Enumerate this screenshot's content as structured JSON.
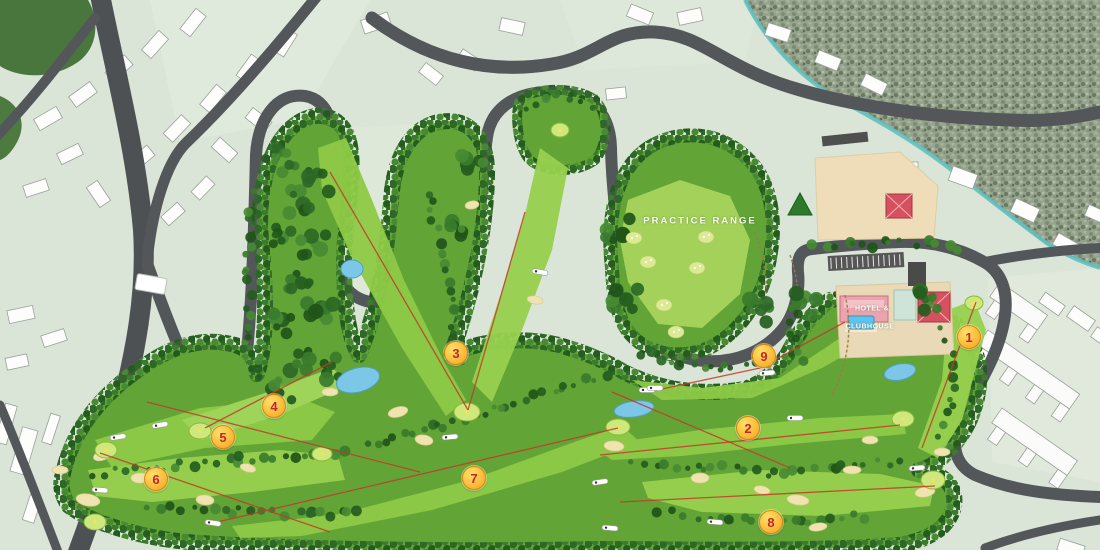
{
  "map": {
    "labels": {
      "practice_range": "PRACTICE RANGE",
      "hotel_clubhouse_line1": "HOTEL &",
      "hotel_clubhouse_line2": "CLUBHOUSE"
    },
    "holes": [
      {
        "number": "1",
        "x": 968,
        "y": 336
      },
      {
        "number": "2",
        "x": 747,
        "y": 427
      },
      {
        "number": "3",
        "x": 455,
        "y": 352
      },
      {
        "number": "4",
        "x": 273,
        "y": 405
      },
      {
        "number": "5",
        "x": 222,
        "y": 436
      },
      {
        "number": "6",
        "x": 155,
        "y": 478
      },
      {
        "number": "7",
        "x": 473,
        "y": 477
      },
      {
        "number": "8",
        "x": 770,
        "y": 521
      },
      {
        "number": "9",
        "x": 763,
        "y": 355
      }
    ],
    "colors": {
      "hole_marker_fill": "#f6a21d",
      "hole_marker_highlight": "#ffe06a",
      "hole_marker_ring": "#e08a00",
      "hole_marker_text": "#c1272d",
      "label_text": "#ffffff",
      "road": "#54575a",
      "rough": "#63a437",
      "fairway": "#8eca46",
      "tree": "#2d6826",
      "water": "#7cc7e8",
      "sand": "#efe3b0",
      "natural_terrain": "#96a38d",
      "stream": "#5fc0bf",
      "hole_line": "#c23b28"
    }
  }
}
